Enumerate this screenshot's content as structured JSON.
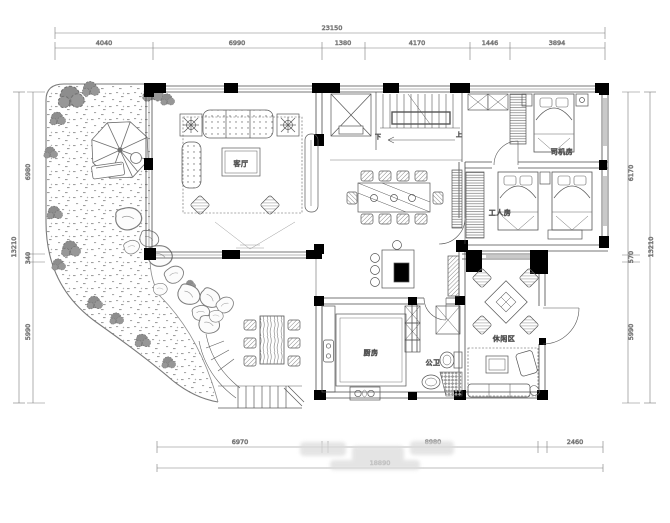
{
  "plan": {
    "rooms": {
      "living_room": "客厅",
      "driver_room": "司机房",
      "worker_room": "工人房",
      "leisure_area": "休闲区",
      "kitchen": "厨房",
      "public_bath": "公卫"
    },
    "stair_labels": {
      "up": "上",
      "down": "下"
    },
    "dimensions": {
      "top": {
        "total": "23150",
        "segments": [
          "4040",
          "6990",
          "1380",
          "4170",
          "1446",
          "3894"
        ]
      },
      "bottom": {
        "total": "18890",
        "segments": [
          "6970",
          "8980",
          "2460"
        ]
      },
      "left": {
        "total": "13210",
        "segments": [
          "6980",
          "340",
          "5990"
        ]
      },
      "right": {
        "total": "13210",
        "segments": [
          "6170",
          "570",
          "5990"
        ]
      }
    },
    "colors": {
      "paper": "#ffffff",
      "line": "#4a4a4a",
      "wall": "#000000",
      "sill": "#c9c9c9",
      "garden": "#8d8d8d",
      "dim_text": "#5a5a5a"
    }
  }
}
